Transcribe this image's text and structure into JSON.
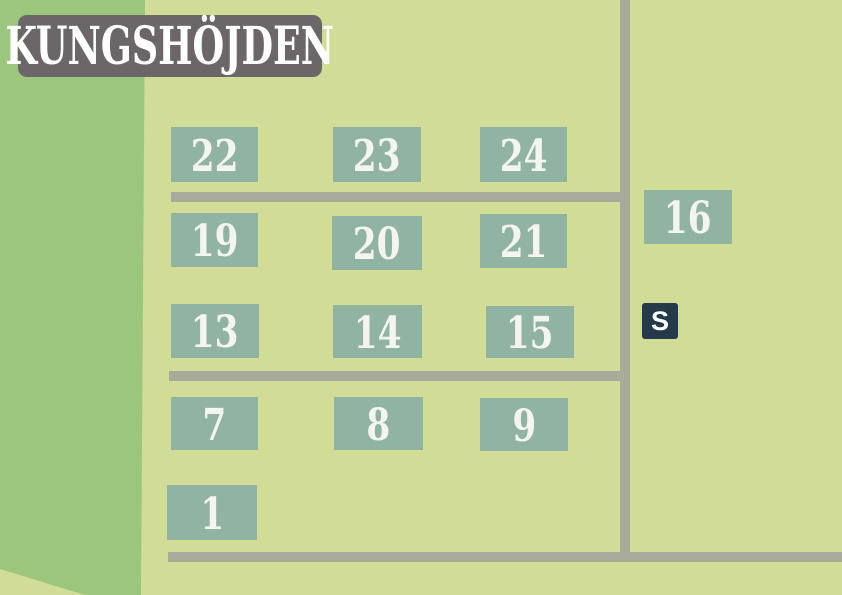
{
  "title": "KUNGSHÖJDEN",
  "map": {
    "plots": [
      {
        "label": "22"
      },
      {
        "label": "23"
      },
      {
        "label": "24"
      },
      {
        "label": "19"
      },
      {
        "label": "20"
      },
      {
        "label": "21"
      },
      {
        "label": "13"
      },
      {
        "label": "14"
      },
      {
        "label": "15"
      },
      {
        "label": "7"
      },
      {
        "label": "8"
      },
      {
        "label": "9"
      },
      {
        "label": "1"
      },
      {
        "label": "16"
      }
    ],
    "service_marker": {
      "label": "S"
    }
  },
  "colors": {
    "background": "#d1dc96",
    "field_green": "#9cc67e",
    "plot_fill": "#90b3a2",
    "road": "#a9ab9a",
    "title_bg": "#6b6768",
    "marker_bg": "#24394a",
    "number_text": "#f4f5ee",
    "title_text": "#ffffff"
  }
}
